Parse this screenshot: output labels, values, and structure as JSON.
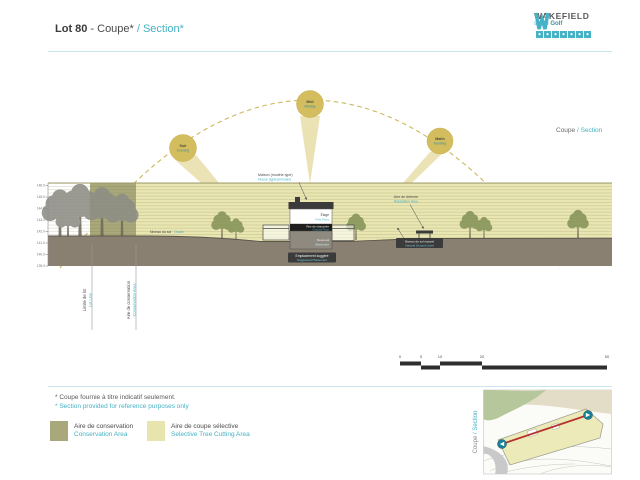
{
  "colors": {
    "accent_teal": "#45b2c5",
    "conservation": "#a9a87b",
    "selective_cut": "#e9e6b2",
    "sun": "#d3bd5e",
    "ground": "#8a8072",
    "dark_text": "#4a4a4a"
  },
  "header": {
    "lot": "Lot 80",
    "title_fr": "- Coupe*",
    "title_en": "/ Section*"
  },
  "logo": {
    "name": "WAKEFIELD",
    "tagline_pre": "sur le ",
    "tagline_bold": "Golf"
  },
  "view_label": {
    "fr": "Coupe ",
    "en": "/ Section"
  },
  "suns": [
    {
      "fr": "Soir",
      "en": "Evening"
    },
    {
      "fr": "Midi",
      "en": "Midday"
    },
    {
      "fr": "Matin",
      "en": "Morning"
    }
  ],
  "drawing": {
    "elevations": [
      "146.0",
      "145.0",
      "144.0",
      "143.0",
      "142.0",
      "141.0",
      "140.0",
      "139.0"
    ],
    "house": {
      "callout_fr": "Maison (modèle type)",
      "callout_en": "House (typical model)",
      "floor_fr": "Étage",
      "floor_en": "First Floor",
      "ground_fr": "Rez-de-chaussée",
      "ground_en": "Ground Floor",
      "basement_fr": "Sous-sol",
      "basement_en": "Basement",
      "suggested_fr": "Emplacement suggéré",
      "suggested_en": "Suggested Placement"
    },
    "labels": {
      "grade_fr": "Niveau du sol",
      "grade_en": "Grade",
      "relax_fr": "Aire de détente",
      "relax_en": "Relaxation Area",
      "natural_fr": "Niveau du sol naturel",
      "natural_en": "Natural Ground Level"
    },
    "boundaries": [
      {
        "fr": "Limite de lot",
        "en": "Lot Line"
      },
      {
        "fr": "Aire de conservation",
        "en": "Conservation Area"
      }
    ]
  },
  "scalebar": {
    "labels": [
      "0",
      "5",
      "10",
      "20",
      "50"
    ]
  },
  "footnote": {
    "fr": "* Coupe fournie à titre indicatif seulement.",
    "en": "* Section provided for reference purposes only"
  },
  "legend": {
    "items": [
      {
        "fr": "Aire de conservation",
        "en": "Conservation Area",
        "color": "#a9a87b"
      },
      {
        "fr": "Aire de coupe sélective",
        "en": "Selective Tree Cutting Area",
        "color": "#e8e4ae"
      }
    ]
  },
  "map": {
    "label_fr": "Coupe ",
    "label_en": "/ Section"
  }
}
